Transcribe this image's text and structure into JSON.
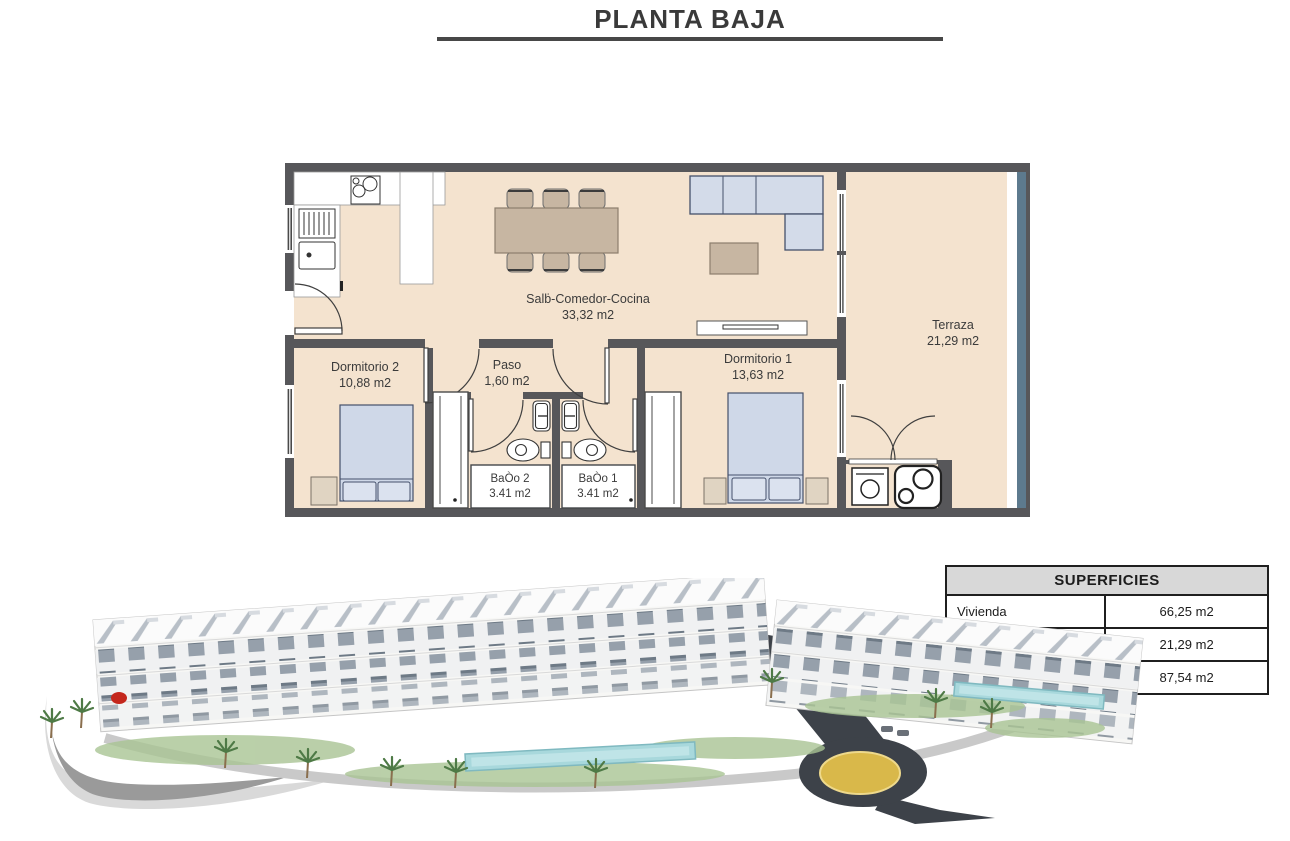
{
  "title": "PLANTA BAJA",
  "floor_plan": {
    "rooms": [
      {
        "name": "Salḃ-Comedor-Cocina",
        "area": "33,32 m2"
      },
      {
        "name": "Terraza",
        "area": "21,29 m2"
      },
      {
        "name": "Dormitorio 2",
        "area": "10,88 m2"
      },
      {
        "name": "Paso",
        "area": "1,60 m2"
      },
      {
        "name": "Dormitorio 1",
        "area": "13,63 m2"
      },
      {
        "name": "BaÒo 2",
        "area": "3.41 m2"
      },
      {
        "name": "BaÒo 1",
        "area": "3.41 m2"
      }
    ]
  },
  "superficies_table": {
    "header": "SUPERFICIES",
    "rows": [
      {
        "label": "Vivienda",
        "value": "66,25 m2"
      },
      {
        "label": "Terraza",
        "value": "21,29 m2"
      },
      {
        "label": "Total",
        "value": "87,54 m2"
      }
    ]
  },
  "colors": {
    "wall": "#57575a",
    "floor_fill": "#f4e3cf",
    "furniture_tan": "#c7b6a2",
    "bed_blue": "#cfd8e8",
    "glass_railing": "#5d7a8e",
    "road_dark": "#3d4249",
    "pool_blue": "#a8d8dc",
    "roundabout_yellow": "#d9b84a",
    "marker_red": "#c4271d"
  }
}
